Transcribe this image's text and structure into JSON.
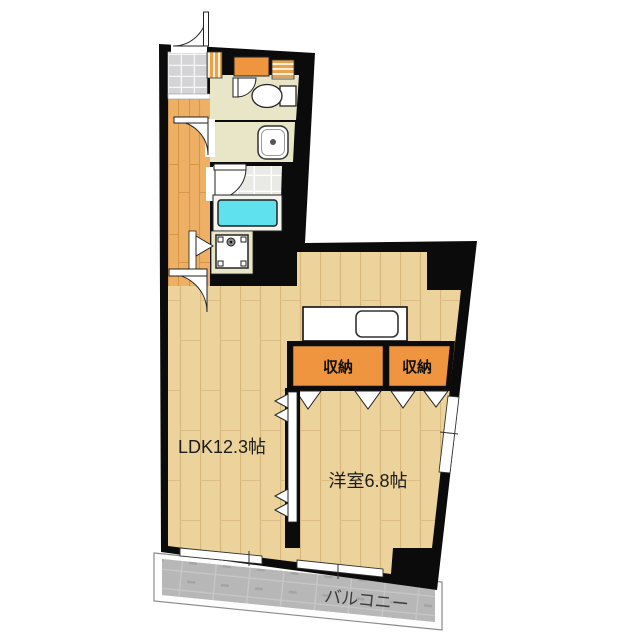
{
  "floorplan": {
    "labels": {
      "ldk": "LDK12.3帖",
      "western_room": "洋室6.8帖",
      "storage_left": "収納",
      "storage_right": "収納",
      "balcony": "バルコニー"
    },
    "colors": {
      "wall": "#0b0b0b",
      "room_floor": "#ecd29b",
      "room_floor_line": "#d9b87e",
      "hall_floor": "#eeb065",
      "hall_floor_line": "#d69748",
      "sanitary_floor": "#e9e6c8",
      "storage": "#f0953f",
      "shoe_cabinet": "#ef9540",
      "bathtub": "#5fe2ee",
      "bath_tile": "#e9e9e6",
      "entrance_tile": "#d4d4d6",
      "balcony_floor": "#b7b7b7",
      "fixture_white": "#ffffff"
    }
  }
}
